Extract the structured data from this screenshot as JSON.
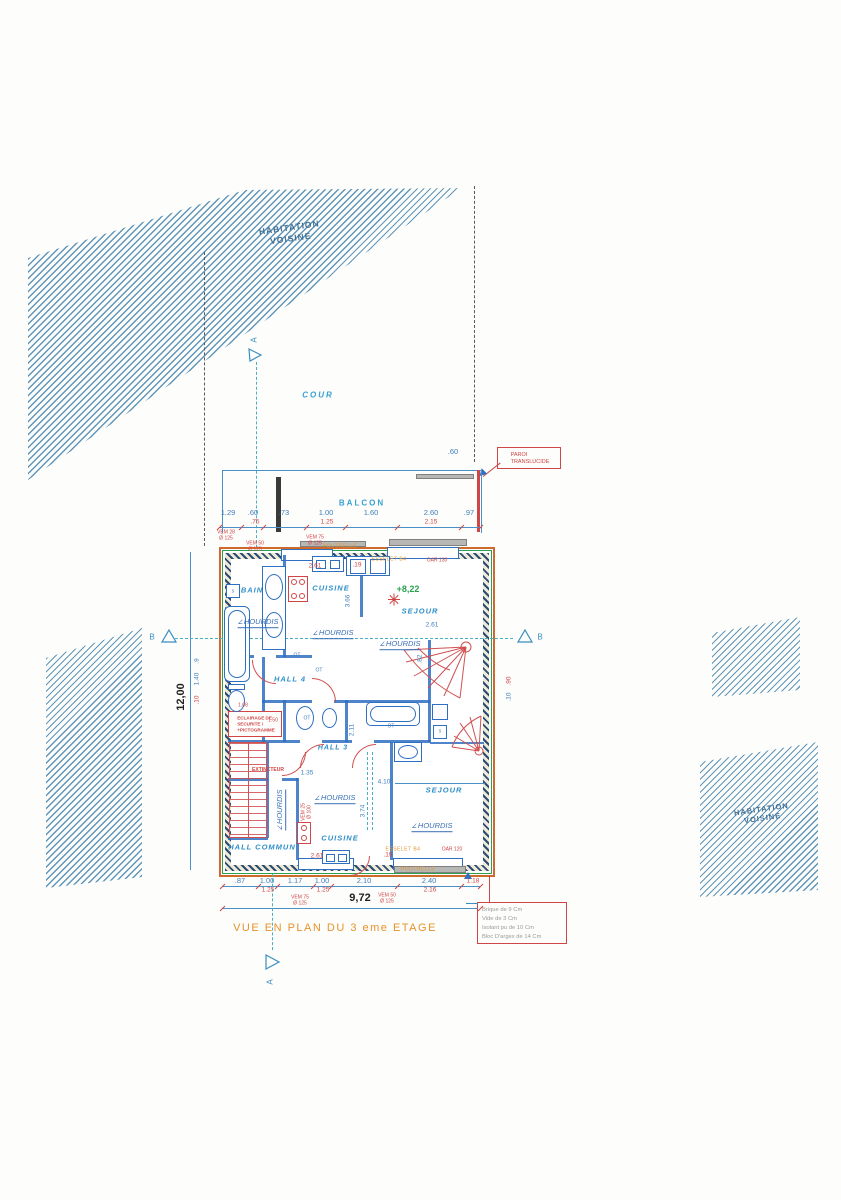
{
  "meta": {
    "caption": "VUE EN PLAN DU 3 eme ETAGE"
  },
  "site": {
    "neighbor_top": "HABITATION\nVOISINE",
    "neighbor_right": "HABITATION\nVOISINE",
    "cour": "COUR",
    "balcon": "BALCON",
    "paroi": "PAROI\nTRANSLUCIDE",
    "section_a": "A",
    "section_b": "B"
  },
  "rooms": {
    "bain": "BAIN",
    "cuisine_top": "CUISINE",
    "sejour_top": "SEJOUR",
    "hall4": "HALL 4",
    "hall3": "HALL 3",
    "hall_commun": "HALL COMMUN",
    "cuisine_bottom": "CUISINE",
    "sejour_bottom": "SEJOUR",
    "elevation": "+8,22"
  },
  "safety": {
    "eclairage": "ECLAIRAGE DE\nSECURITE !\n+PICTOGRAMME",
    "extincteur": "EXTINCTEUR"
  },
  "overall": {
    "width": "9,72",
    "height": "12,00"
  },
  "notes": {
    "lines": [
      "Brique de 9 Cm",
      "Vide de 3 Cm",
      "Isolant pu de 10 Cm",
      "Bloc D'argex de 14 Cm"
    ]
  },
  "colors": {
    "hatch_blue": "#6096ba",
    "dim_blue": "#3f7fbe",
    "label_cyan": "#35a0d2",
    "red": "#d04545",
    "orange": "#e2932d",
    "green": "#2aa14f"
  },
  "overlays": [
    {
      "n": "dim-top-1",
      "t": "1.29",
      "x": 228,
      "y": 513,
      "c": "b7"
    },
    {
      "n": "dim-top-2",
      "t": ".60",
      "x": 253,
      "y": 513,
      "c": "b7"
    },
    {
      "n": "dim-top-3",
      "t": ".73",
      "x": 284,
      "y": 513,
      "c": "b7"
    },
    {
      "n": "dim-top-4",
      "t": "1.00",
      "x": 326,
      "y": 513,
      "c": "b7"
    },
    {
      "n": "dim-top-5",
      "t": "1.60",
      "x": 371,
      "y": 513,
      "c": "b7"
    },
    {
      "n": "dim-top-6",
      "t": "2.60",
      "x": 431,
      "y": 513,
      "c": "b7"
    },
    {
      "n": "dim-top-7",
      "t": ".97",
      "x": 469,
      "y": 513,
      "c": "b7"
    },
    {
      "n": "dim-top-sub-1",
      "t": ".75",
      "x": 255,
      "y": 522,
      "c": "r6"
    },
    {
      "n": "dim-top-sub-2",
      "t": "1.25",
      "x": 327,
      "y": 522,
      "c": "r6"
    },
    {
      "n": "dim-top-sub-3",
      "t": "2.15",
      "x": 431,
      "y": 522,
      "c": "r6"
    },
    {
      "n": "dim-paroi-offset",
      "t": ".60",
      "x": 453,
      "y": 452,
      "c": "b7"
    },
    {
      "n": "vent-vem28",
      "t": "VEM 28\nØ 125",
      "x": 226,
      "y": 536,
      "c": "r5"
    },
    {
      "n": "vent-vem50",
      "t": "VEM 50\nØ 125",
      "x": 255,
      "y": 547,
      "c": "r5"
    },
    {
      "n": "vent-vem75",
      "t": "VEM 75\nØ 125",
      "x": 315,
      "y": 541,
      "c": "r5"
    },
    {
      "n": "beam-poutrelle-top",
      "t": "POUTRELLE",
      "x": 340,
      "y": 547,
      "c": "o5"
    },
    {
      "n": "beam-esselet-top",
      "t": "ESSELET B4",
      "x": 389,
      "y": 560,
      "c": "o5"
    },
    {
      "n": "beam-oar-top",
      "t": "OAR 130",
      "x": 437,
      "y": 561,
      "c": "r5"
    },
    {
      "n": "dim-kitchen-1",
      "t": "2.61",
      "x": 315,
      "y": 566,
      "c": "r6"
    },
    {
      "n": "dim-kitchen-2",
      "t": ".19",
      "x": 357,
      "y": 565,
      "c": "r6"
    },
    {
      "n": "dim-kitchen-3",
      "t": "3.66",
      "x": 348,
      "y": 601,
      "c": "b6",
      "r": -90
    },
    {
      "n": "dim-sejour-top",
      "t": "2.61",
      "x": 432,
      "y": 625,
      "c": "b6"
    },
    {
      "n": "dim-stair-top",
      "t": ".82",
      "x": 420,
      "y": 659,
      "c": "b6",
      "r": -90
    },
    {
      "n": "dim-left-1",
      "t": ".9",
      "x": 197,
      "y": 661,
      "c": "b6",
      "r": -90
    },
    {
      "n": "dim-left-2",
      "t": "1.40",
      "x": 197,
      "y": 679,
      "c": "b6",
      "r": -90
    },
    {
      "n": "dim-left-3",
      "t": ".10",
      "x": 197,
      "y": 700,
      "c": "r6",
      "r": -90
    },
    {
      "n": "dim-right-1",
      "t": ".90",
      "x": 509,
      "y": 681,
      "c": "r6",
      "r": -90
    },
    {
      "n": "dim-right-2",
      "t": ".10",
      "x": 509,
      "y": 697,
      "c": "b6",
      "r": -90
    },
    {
      "n": "dim-hall4-1",
      "t": "1.08",
      "x": 243,
      "y": 706,
      "c": "r5"
    },
    {
      "n": "dim-wc-1",
      "t": "1.50",
      "x": 273,
      "y": 721,
      "c": "r5"
    },
    {
      "n": "ot-1",
      "t": "OT",
      "x": 297,
      "y": 656,
      "c": "b5"
    },
    {
      "n": "ot-2",
      "t": "OT",
      "x": 319,
      "y": 671,
      "c": "b5"
    },
    {
      "n": "ot-3",
      "t": "OT",
      "x": 307,
      "y": 719,
      "c": "b5"
    },
    {
      "n": "ot-4",
      "t": "OT",
      "x": 391,
      "y": 727,
      "c": "b5"
    },
    {
      "n": "dim-bath-1",
      "t": "2.11",
      "x": 352,
      "y": 730,
      "c": "b6",
      "r": -90
    },
    {
      "n": "dim-hall3-1",
      "t": "1.35",
      "x": 307,
      "y": 773,
      "c": "b6"
    },
    {
      "n": "dim-hall3-2",
      "t": "4.10",
      "x": 384,
      "y": 782,
      "c": "b6"
    },
    {
      "n": "vent-vem25",
      "t": "VEM 25\nØ 100",
      "x": 307,
      "y": 812,
      "c": "r5",
      "r": -90
    },
    {
      "n": "dim-cuisine2-1",
      "t": "3.74",
      "x": 363,
      "y": 811,
      "c": "b6",
      "r": -90
    },
    {
      "n": "dim-cuisine2-2",
      "t": "2.61",
      "x": 317,
      "y": 856,
      "c": "r6"
    },
    {
      "n": "dim-cuisine2-3",
      "t": ".19",
      "x": 388,
      "y": 855,
      "c": "r6"
    },
    {
      "n": "beam-esselet-bottom",
      "t": "ESSELET B4",
      "x": 403,
      "y": 850,
      "c": "o5"
    },
    {
      "n": "beam-oar-bottom",
      "t": "OAR 120",
      "x": 452,
      "y": 850,
      "c": "r5"
    },
    {
      "n": "beam-poutrelle-bottom",
      "t": "POUTRELLE",
      "x": 418,
      "y": 870,
      "c": "o5"
    },
    {
      "n": "dim-bot-1",
      "t": ".87",
      "x": 240,
      "y": 881,
      "c": "b7"
    },
    {
      "n": "dim-bot-2",
      "t": "1.00",
      "x": 267,
      "y": 881,
      "c": "b7"
    },
    {
      "n": "dim-bot-3",
      "t": "1.17",
      "x": 295,
      "y": 881,
      "c": "b7"
    },
    {
      "n": "dim-bot-4",
      "t": "1.00",
      "x": 322,
      "y": 881,
      "c": "b7"
    },
    {
      "n": "dim-bot-5",
      "t": "2.10",
      "x": 364,
      "y": 881,
      "c": "b7"
    },
    {
      "n": "dim-bot-6",
      "t": "2.40",
      "x": 429,
      "y": 881,
      "c": "b7"
    },
    {
      "n": "dim-bot-7",
      "t": "1.18",
      "x": 473,
      "y": 881,
      "c": "r6"
    },
    {
      "n": "dim-bot-sub-1",
      "t": "1.25",
      "x": 268,
      "y": 890,
      "c": "r6"
    },
    {
      "n": "dim-bot-sub-2",
      "t": "1.25",
      "x": 323,
      "y": 890,
      "c": "r6"
    },
    {
      "n": "dim-bot-sub-3",
      "t": "2.16",
      "x": 430,
      "y": 890,
      "c": "r6"
    },
    {
      "n": "vent-vem75b",
      "t": "VEM 75\nØ 125",
      "x": 300,
      "y": 901,
      "c": "r5"
    },
    {
      "n": "vent-vem50b",
      "t": "VEM 50\nØ 125",
      "x": 387,
      "y": 899,
      "c": "r5"
    },
    {
      "n": "hourdis-1",
      "t": "HOURDIS",
      "x": 258,
      "y": 623,
      "c": "hrd"
    },
    {
      "n": "hourdis-2",
      "t": "HOURDIS",
      "x": 333,
      "y": 634,
      "c": "hrd"
    },
    {
      "n": "hourdis-3",
      "t": "HOURDIS",
      "x": 400,
      "y": 645,
      "c": "hrd"
    },
    {
      "n": "hourdis-4",
      "t": "HOURDIS",
      "x": 335,
      "y": 799,
      "c": "hrd"
    },
    {
      "n": "hourdis-5",
      "t": "HOURDIS",
      "x": 281,
      "y": 810,
      "c": "hrd",
      "r": -90
    },
    {
      "n": "hourdis-6",
      "t": "HOURDIS",
      "x": 432,
      "y": 827,
      "c": "hrd"
    },
    {
      "n": "sink-symbol-1",
      "t": "s",
      "x": 233,
      "y": 592,
      "c": "b5"
    },
    {
      "n": "sink-symbol-2",
      "t": "s",
      "x": 440,
      "y": 732,
      "c": "b5"
    }
  ]
}
